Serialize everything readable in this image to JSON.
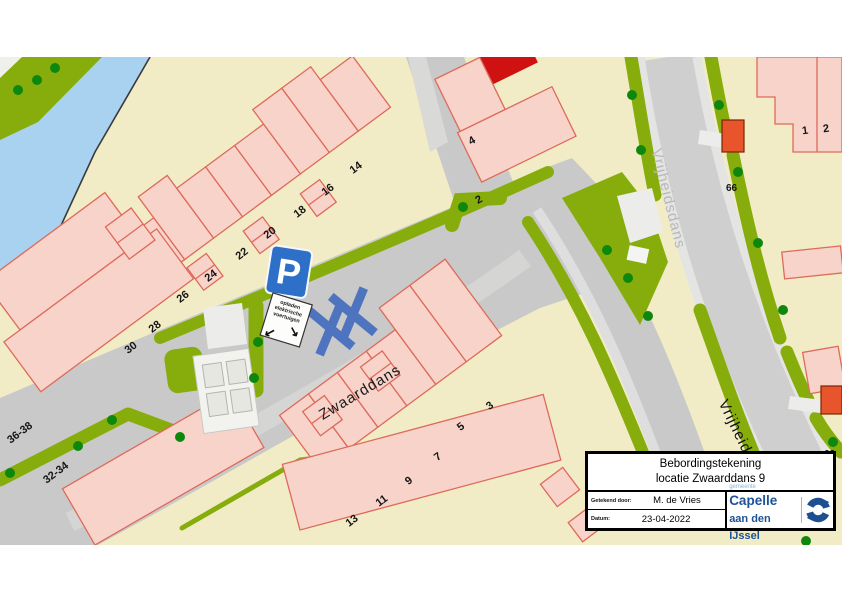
{
  "map": {
    "street_labels": {
      "zwaarddans": "Zwaarddans",
      "vrijheidsdans_top": "Vrijheidsdans",
      "vrijheidsdans_bottom": "Vrijheidsdans"
    },
    "house_numbers": {
      "n14": "14",
      "n16": "16",
      "n18": "18",
      "n20": "20",
      "n22": "22",
      "n24": "24",
      "n26": "26",
      "n28": "28",
      "n30": "30",
      "n4": "4",
      "n2_mid": "2",
      "n1": "1",
      "n2_right": "2",
      "n66": "66",
      "n62": "62",
      "n3": "3",
      "n5": "5",
      "n7": "7",
      "n9": "9",
      "n11": "11",
      "n13": "13",
      "n36_38": "36-38",
      "n32_34": "32-34"
    }
  },
  "parking_sign": {
    "p": "P",
    "line1": "opladen",
    "line2": "elektrische",
    "line3": "voertuigen",
    "arrow_left": "↙",
    "arrow_right": "↘"
  },
  "title_block": {
    "title_line1": "Bebordingstekening",
    "title_line2": "locatie Zwaarddans 9",
    "drawn_by_label": "Getekend door:",
    "drawn_by": "M. de Vries",
    "date_label": "Datum:",
    "date": "23-04-2022",
    "logo": {
      "gemeente": "gemeente",
      "name_line1": "Capelle",
      "name_line2": "aan den IJssel"
    }
  },
  "colors": {
    "land": "#f2ecc6",
    "water": "#a9d2f1",
    "green": "#86ad0c",
    "tree": "#0d870d",
    "road": "#c9c9c9",
    "sidewalk": "#e4e4e3",
    "house_fill": "#f8d3ca",
    "house_stroke": "#dd6a5a",
    "red_building": "#cf1111",
    "orange_building": "#e8542c",
    "sign_blue": "#2e70c8",
    "cross_blue": "#4e74c0",
    "logo_blue": "#1d5296"
  }
}
